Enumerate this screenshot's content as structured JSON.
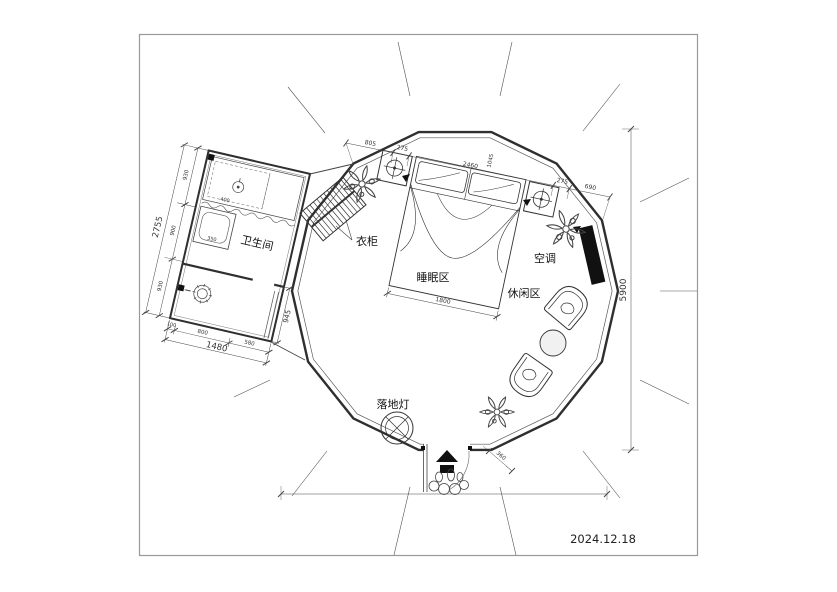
{
  "meta": {
    "date": "2024.12.18"
  },
  "labels": {
    "bathroom": "卫生间",
    "wardrobe": "衣柜",
    "sleeping_area": "睡眠区",
    "leisure_area": "休闲区",
    "air_conditioner": "空调",
    "floor_lamp": "落地灯"
  },
  "dimensions": {
    "top_chain": [
      "805",
      "275",
      "2460",
      "275",
      "690"
    ],
    "top_cross": "1045",
    "bed_width": "1800",
    "overall_height": "5900",
    "entry_width": "360",
    "bath_left_chain": [
      "930",
      "900",
      "930"
    ],
    "bath_left_total": "2755",
    "bath_bottom_chain": [
      "100",
      "800",
      "580"
    ],
    "bath_bottom_total": "1480",
    "bath_right": "945",
    "vanity_width": "400",
    "shower_width": "350"
  },
  "colors": {
    "wall": "#2f2f2f",
    "thin_line": "#555555",
    "dim_line": "#444444",
    "black_fill": "#111111",
    "frame": "#999999"
  }
}
